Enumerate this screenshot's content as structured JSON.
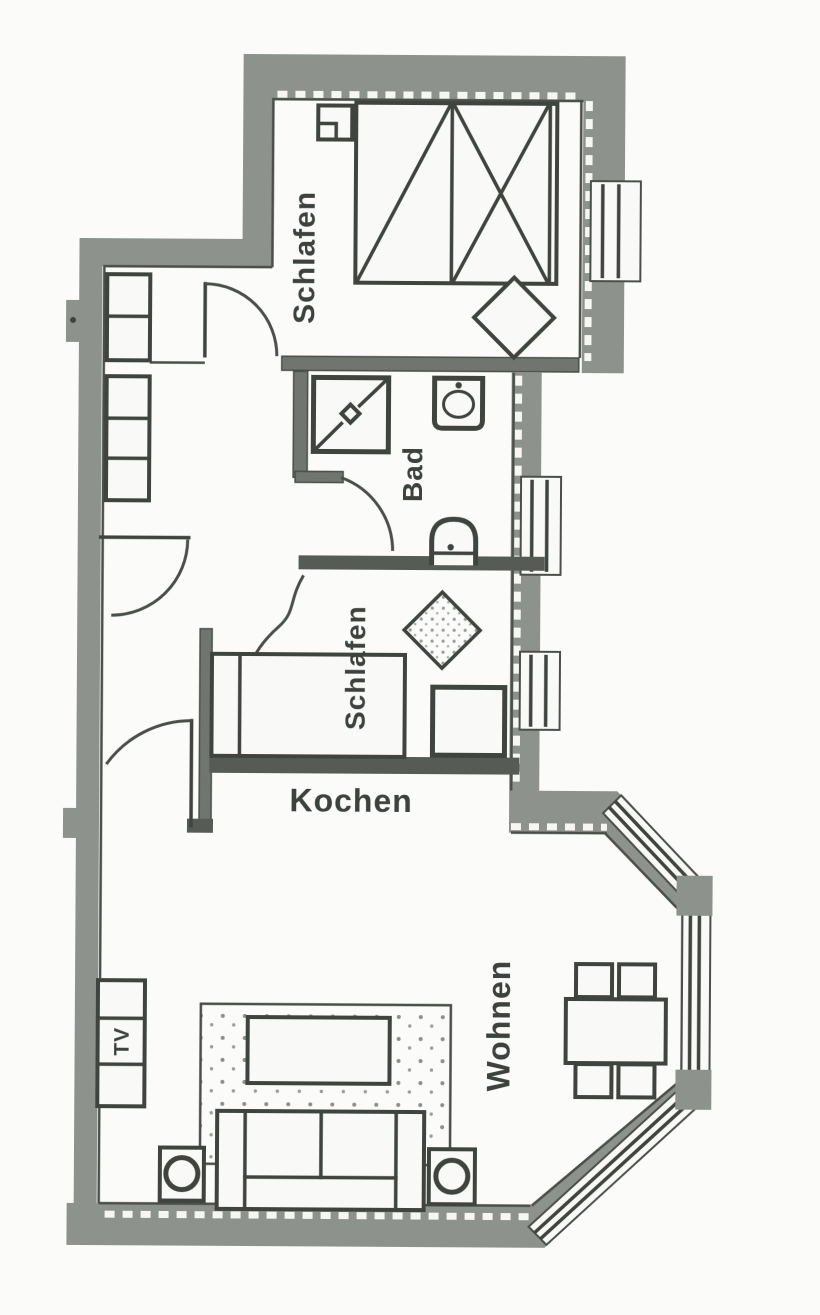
{
  "plan": {
    "labels": {
      "bedroom_top": "Schlafen",
      "bath": "Bad",
      "bedroom_alcove": "Schlafen",
      "kitchen": "Kochen",
      "living": "Wohnen",
      "tv": "TV"
    },
    "colors": {
      "wall_gray": "#8d938c",
      "interior_wall_gray": "#70766f",
      "dark_wall": "#565b55",
      "line": "#3f443e",
      "text": "#3d423d",
      "background": "#fbfbf9",
      "floor_white": "#f6f6f3"
    }
  }
}
